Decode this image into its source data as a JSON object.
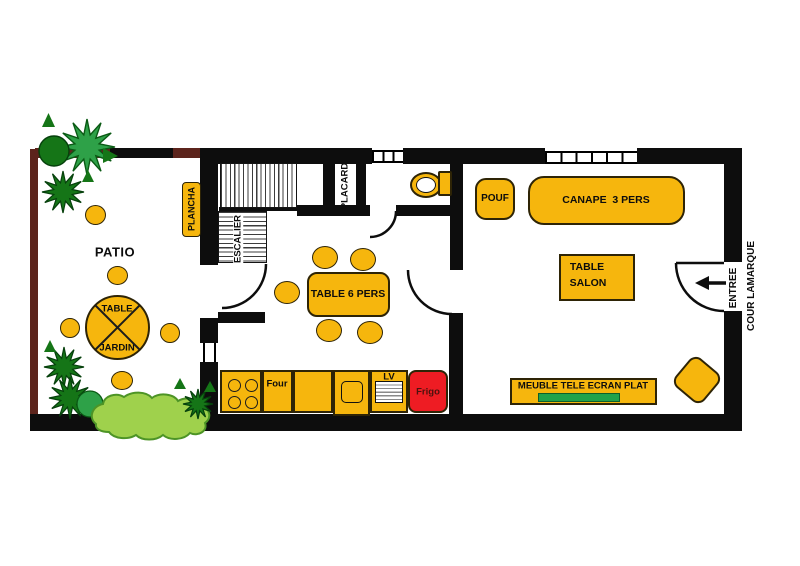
{
  "plan_title": "apartment-floor-plan",
  "patio": {
    "label": "PATIO",
    "plancha": "PLANCHA",
    "table_line1": "TABLE",
    "table_line2": "JARDIN"
  },
  "kitchen": {
    "stairs": "ESCALIER",
    "closet": "PLACARD",
    "table": "TABLE 6 PERS",
    "oven": "Four",
    "dishwasher": "LV",
    "fridge": "Frigo"
  },
  "living": {
    "pouf": "POUF",
    "sofa": "CANAPE  3 PERS",
    "table_line1": "TABLE",
    "table_line2": "SALON",
    "tv_unit": "MEUBLE TELE ECRAN PLAT"
  },
  "entry": {
    "line1": "ENTREE",
    "line2": "COUR LAMARQUE"
  },
  "colors": {
    "wall": "#0d0d0d",
    "garden_wall": "#5c241c",
    "furniture": "#f6b60d",
    "fridge": "#ee1c23",
    "fridge_text": "#4a120e",
    "tv_screen": "#21a24b",
    "tree_dark": "#157517",
    "tree_mid": "#2ea148",
    "bush_light": "#9fd14c"
  }
}
